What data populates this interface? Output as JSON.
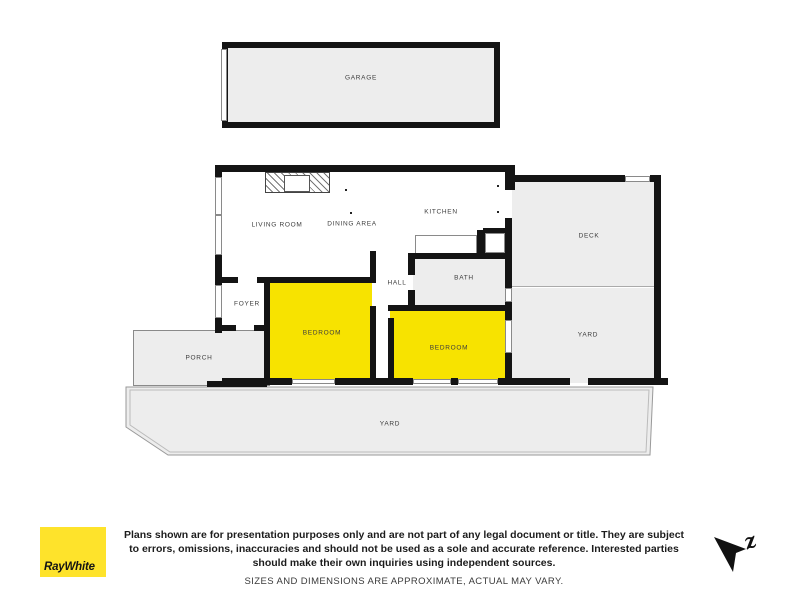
{
  "plan": {
    "rooms": {
      "garage": "GARAGE",
      "living_room": "LIVING ROOM",
      "dining_area": "DINING AREA",
      "kitchen": "KITCHEN",
      "deck": "DECK",
      "yard_right": "YARD",
      "hall": "HALL",
      "bath": "BATH",
      "foyer": "FOYER",
      "bedroom_1": "BEDROOM",
      "bedroom_2": "BEDROOM",
      "porch": "PORCH",
      "yard_bottom": "YARD"
    },
    "colors": {
      "wall": "#141414",
      "room_fill": "#ededed",
      "bedroom_highlight": "#f7e300",
      "brand_yellow": "#fee32b"
    }
  },
  "footer": {
    "brand": "RayWhite",
    "disclaimer": "Plans shown are for presentation purposes only and are not part of any legal document or title. They are subject to errors, omissions, inaccuracies and should not be used as a sole and accurate reference. Interested parties should make their own inquiries using independent sources.",
    "note": "SIZES AND DIMENSIONS ARE APPROXIMATE, ACTUAL MAY VARY.",
    "north_label": "z"
  }
}
